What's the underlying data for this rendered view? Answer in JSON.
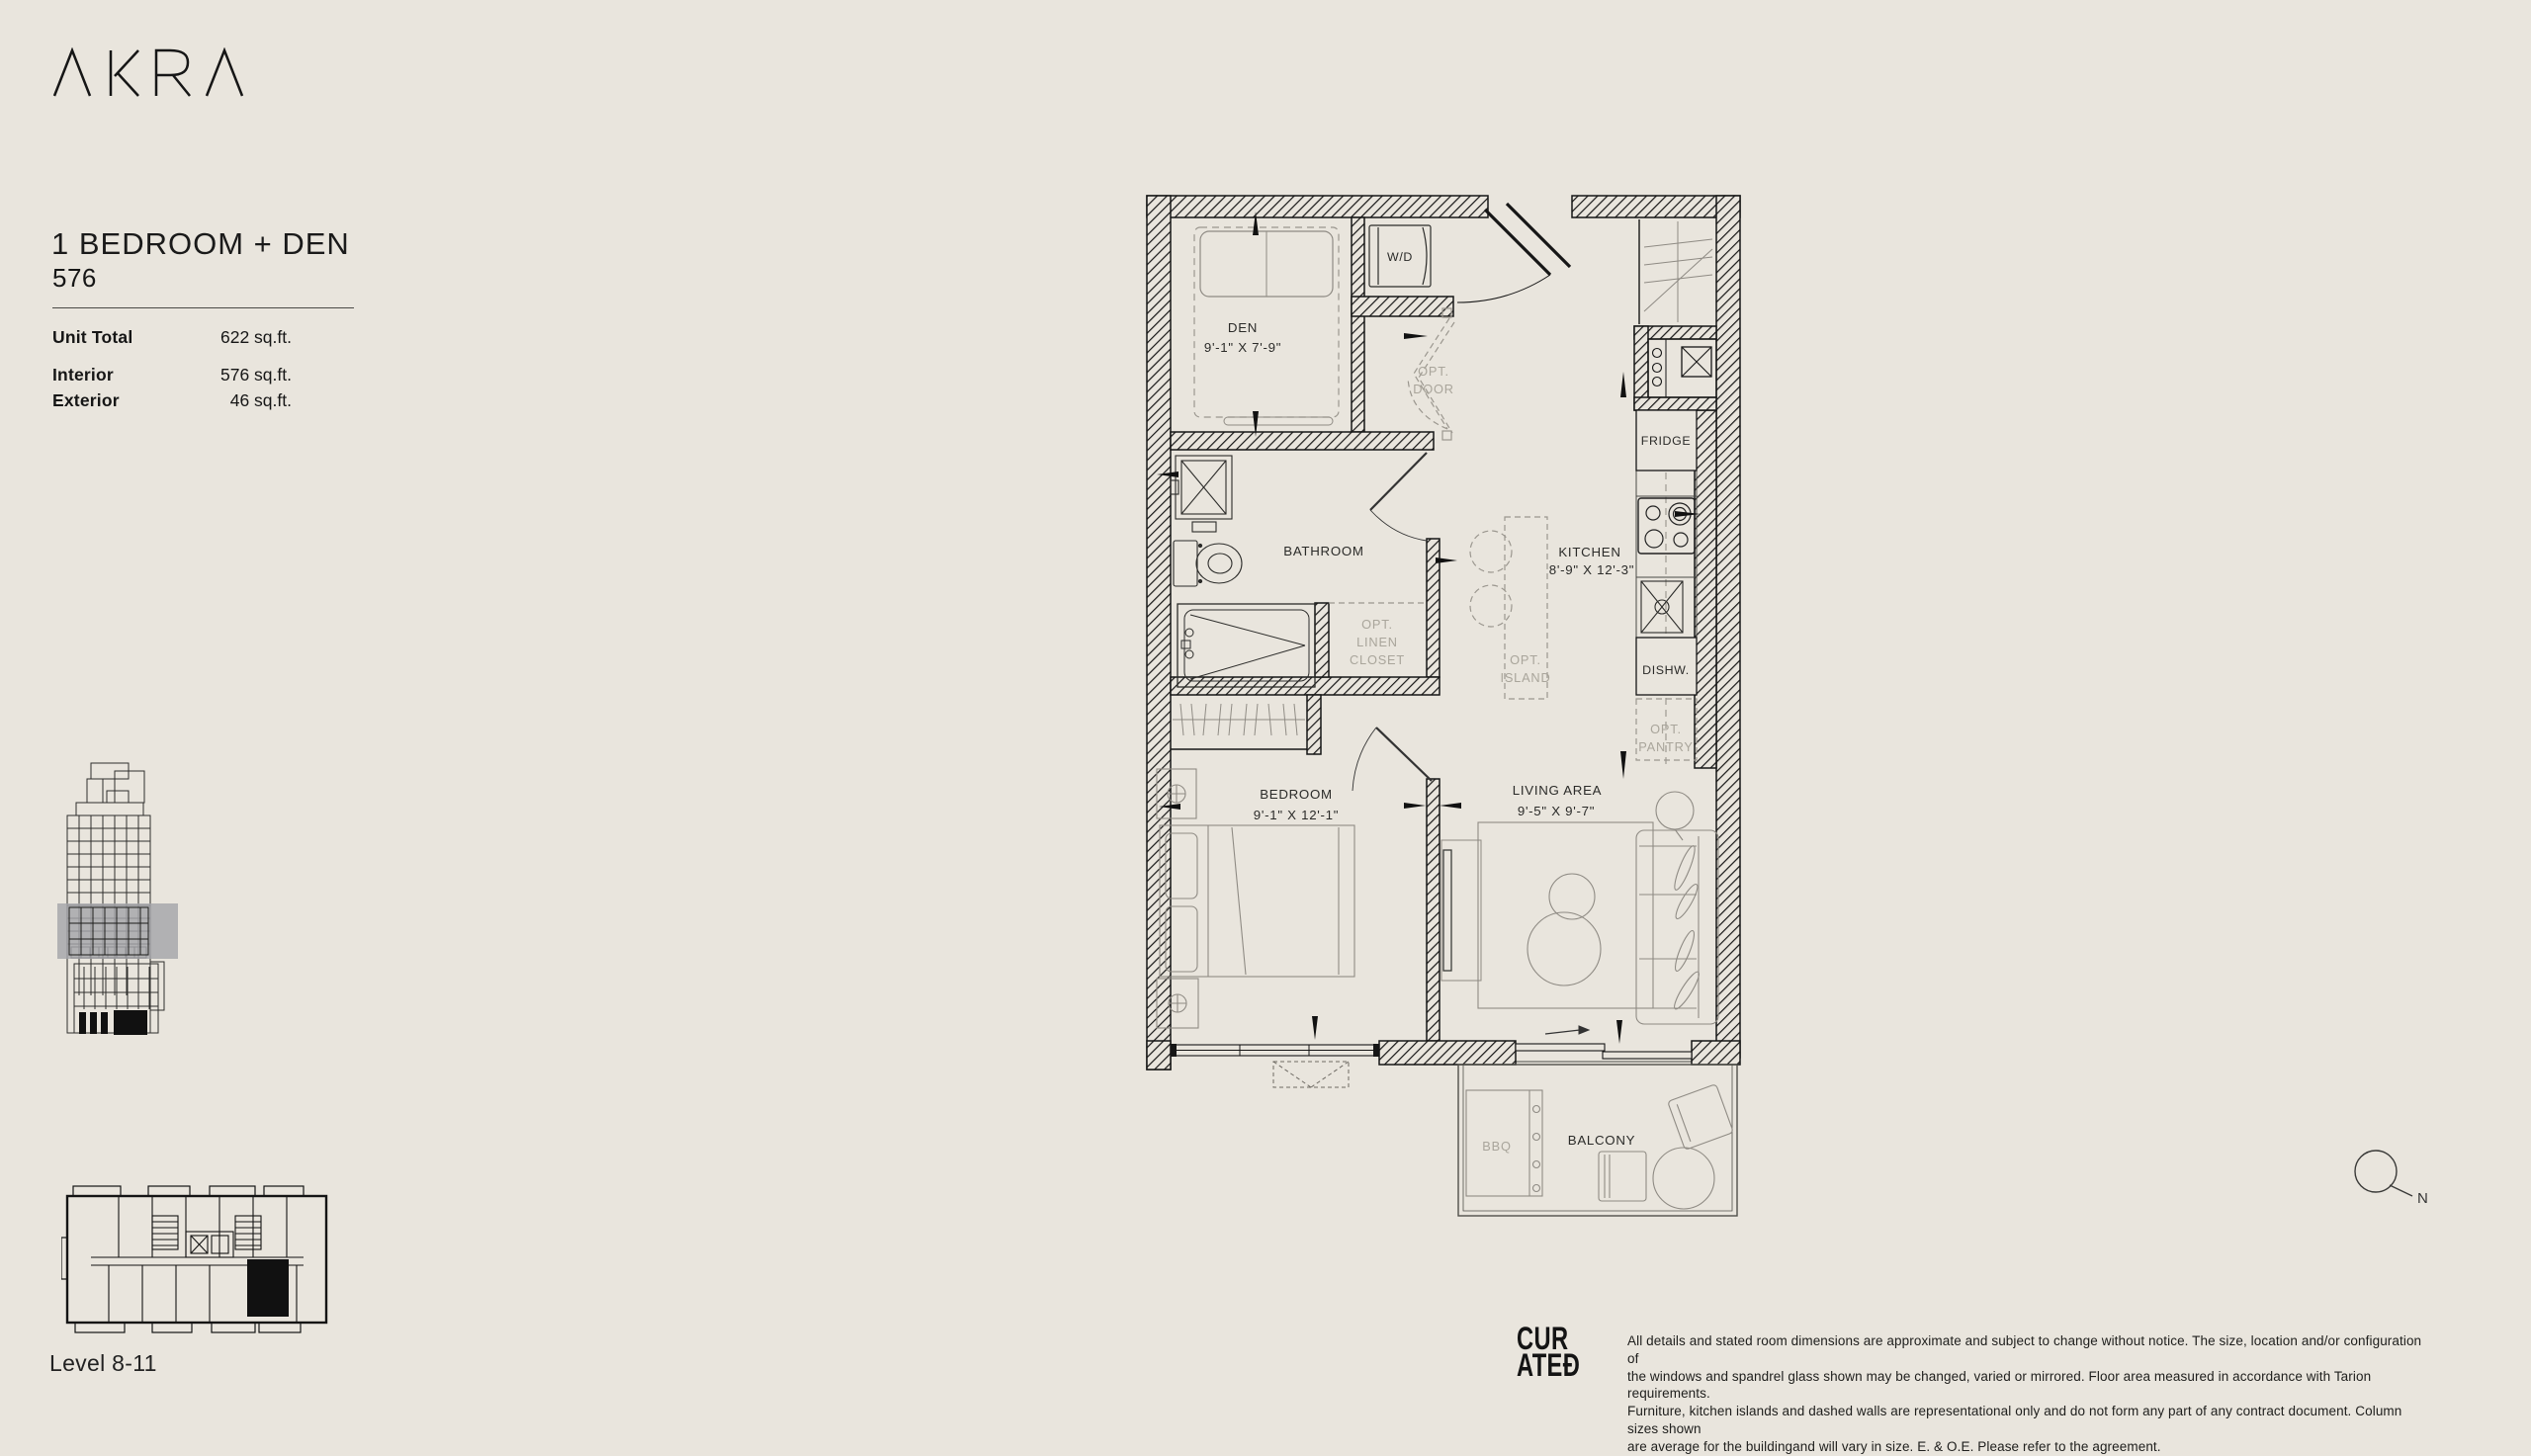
{
  "brand": {
    "logo_text": "AKRA"
  },
  "unit": {
    "title": "1 BEDROOM + DEN",
    "number": "576"
  },
  "stats": {
    "rows": [
      {
        "label": "Unit Total",
        "value": "622 sq.ft."
      },
      {
        "label": "Interior",
        "value": "576 sq.ft."
      },
      {
        "label": "Exterior",
        "value": "46 sq.ft."
      }
    ]
  },
  "key_plan": {
    "level_label": "Level 8-11"
  },
  "floor_plan": {
    "rooms": {
      "den": {
        "name": "DEN",
        "dims": "9'-1\" X 7'-9\""
      },
      "wd": {
        "name": "W/D"
      },
      "opt_door": {
        "line1": "OPT.",
        "line2": "DOOR"
      },
      "bathroom": {
        "name": "BATHROOM"
      },
      "linen": {
        "line1": "OPT.",
        "line2": "LINEN",
        "line3": "CLOSET"
      },
      "kitchen": {
        "name": "KITCHEN",
        "dims": "8'-9\" X 12'-3\""
      },
      "fridge": {
        "name": "FRIDGE"
      },
      "dishw": {
        "name": "DISHW."
      },
      "island": {
        "line1": "OPT.",
        "line2": "ISLAND"
      },
      "pantry": {
        "line1": "OPT.",
        "line2": "PANTRY"
      },
      "bedroom": {
        "name": "BEDROOM",
        "dims": "9'-1\" X 12'-1\""
      },
      "living": {
        "name": "LIVING AREA",
        "dims": "9'-5\" X 9'-7\""
      },
      "bbq": {
        "name": "BBQ"
      },
      "balcony": {
        "name": "BALCONY"
      }
    }
  },
  "compass": {
    "label": "N"
  },
  "footer": {
    "logo_line1": "CUR",
    "logo_line2": "ATEĐ",
    "disclaimer_lines": [
      "All details and stated room dimensions are approximate and subject to change without notice. The size, location and/or configuration of",
      "the windows and spandrel glass shown may be changed, varied or mirrored. Floor area measured in accordance with Tarion requirements.",
      "Furniture, kitchen islands and dashed walls are representational only and do not form any part of any contract document. Column sizes shown",
      "are average for the buildingand will vary in size. E. & O.E. Please refer to the agreement."
    ]
  },
  "colors": {
    "background": "#e9e5dd",
    "ink": "#161616",
    "muted": "#a9a59b",
    "highlight": "#a5a5a9"
  }
}
